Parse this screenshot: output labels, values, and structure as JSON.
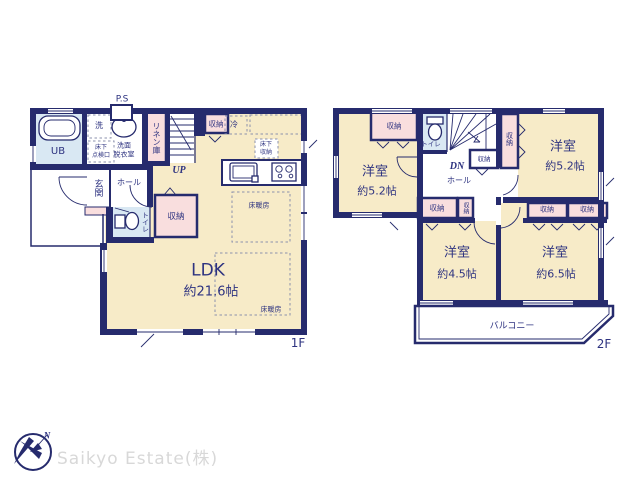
{
  "colors": {
    "wall": "#262b6d",
    "text": "#2e3380",
    "room_cream": "#f7ebc8",
    "closet_pink": "#f9dede",
    "bath_blue": "#d9e8f3",
    "dash": "#8b90ad",
    "watermark": "#d8d8d8"
  },
  "watermark": "Saikyo Estate(株)",
  "compass": {
    "north": "N"
  },
  "floor1": {
    "label": "1F",
    "ps": "P.S",
    "laundry": "洗",
    "washroom": [
      "洗面",
      "脱衣室"
    ],
    "underfloor_access": [
      "床下",
      "点検口"
    ],
    "unit_bath": "UB",
    "linen_closet": "リネン庫",
    "stairs_up": "UP",
    "closet_top": "収納",
    "fridge": "冷",
    "underfloor_storage": [
      "床下",
      "収納"
    ],
    "entrance": "玄関",
    "hall": "ホール",
    "toilet": "トイレ",
    "closet_hall": "収納",
    "ldk_name": "LDK",
    "ldk_size": "約21.6帖",
    "floor_heating_1": "床暖房",
    "floor_heating_2": "床暖房"
  },
  "floor2": {
    "label": "2F",
    "toilet": "トイレ",
    "stairs_down": "DN",
    "hall": "ホール",
    "balcony": "バルコニー",
    "room_top_left_name": "洋室",
    "room_top_left_size": "約5.2帖",
    "room_top_right_name": "洋室",
    "room_top_right_size": "約5.2帖",
    "room_bottom_left_name": "洋室",
    "room_bottom_left_size": "約4.5帖",
    "room_bottom_right_name": "洋室",
    "room_bottom_right_size": "約6.5帖",
    "closet_top_left": "収納",
    "closet_stairs_side": "収納",
    "closet_under_stairs": "収納",
    "closet_mid_left": "収納",
    "closet_mid_small": "収納",
    "closet_mid_right_1": "収納",
    "closet_mid_right_2": "収納"
  }
}
